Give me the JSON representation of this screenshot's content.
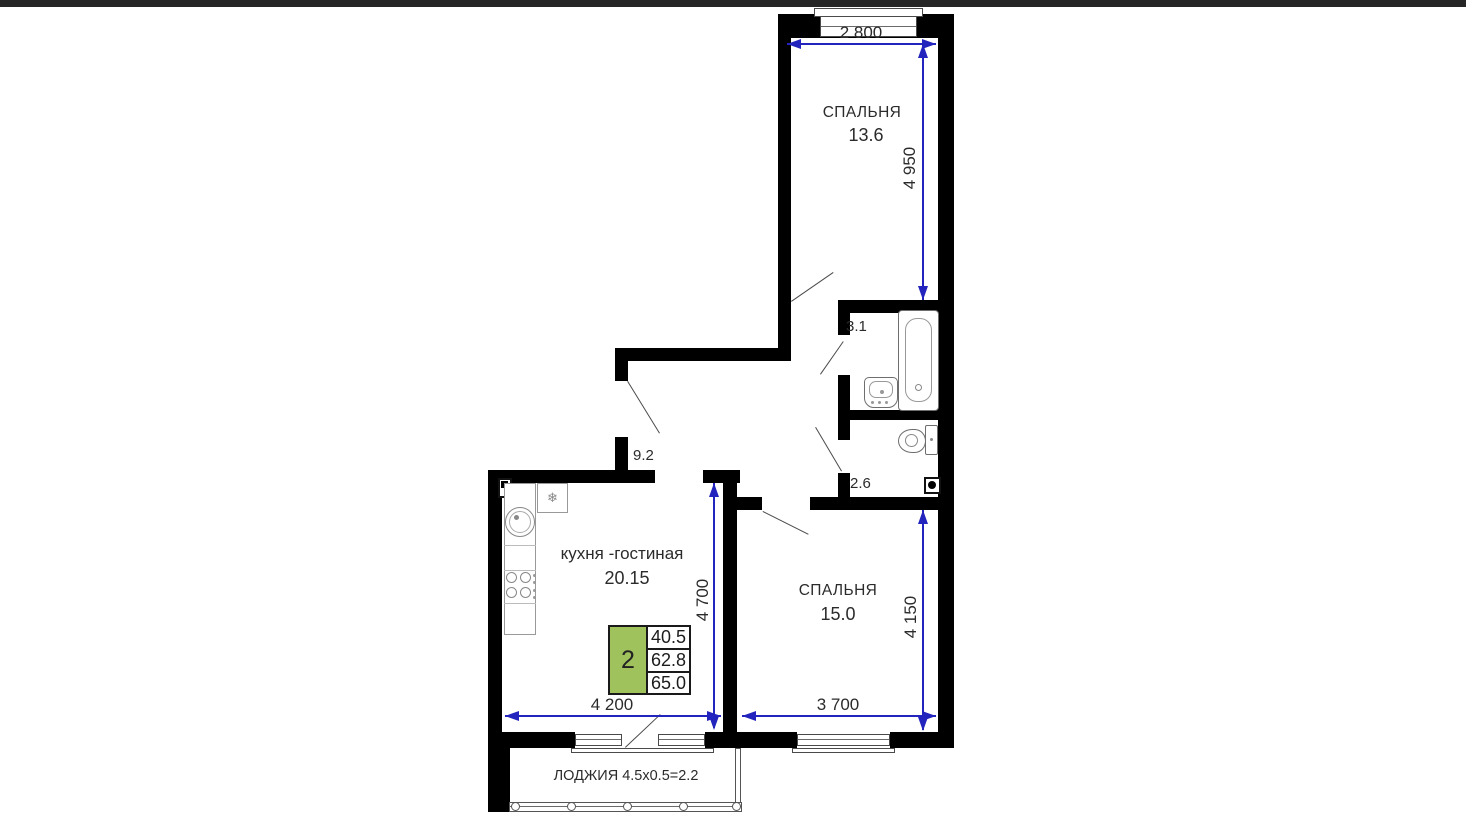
{
  "colors": {
    "topbar": "#262626",
    "wall": "#000000",
    "dimension": "#2323bd",
    "accent": "#9fc25d",
    "text": "#2b2b2b",
    "fixture": "#6e6e6e"
  },
  "rooms": {
    "bedroom1": {
      "name": "СПАЛЬНЯ",
      "area": "13.6"
    },
    "bedroom2": {
      "name": "СПАЛЬНЯ",
      "area": "15.0"
    },
    "kitchen_living": {
      "name": "кухня -гостиная",
      "area": "20.15"
    },
    "bathroom": {
      "area": "3.1"
    },
    "toilet": {
      "area": "2.6"
    },
    "hallway": {
      "area": "9.2"
    },
    "loggia": {
      "label": "ЛОДЖИЯ 4.5x0.5=2.2"
    }
  },
  "dimensions": {
    "bedroom1_width": "2 800",
    "bedroom1_depth": "4 950",
    "kitchen_depth": "4 700",
    "bedroom2_depth": "4 150",
    "kitchen_width": "4 200",
    "bedroom2_width": "3 700"
  },
  "info_box": {
    "rooms_count": "2",
    "areas": [
      "40.5",
      "62.8",
      "65.0"
    ]
  },
  "icons": {
    "fridge": "❄"
  }
}
